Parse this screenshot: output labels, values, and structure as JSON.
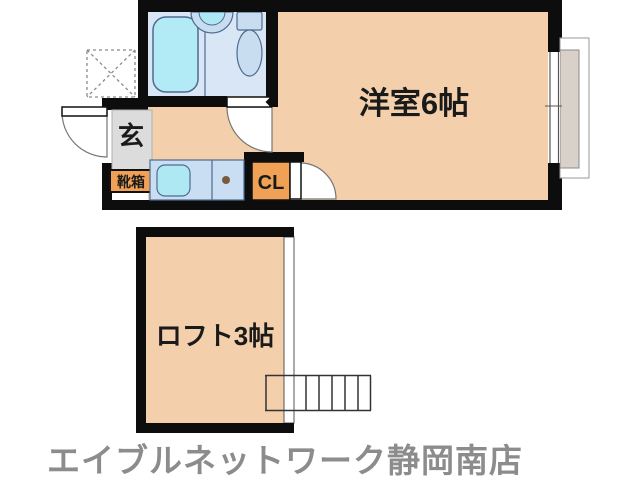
{
  "plan": {
    "labels": {
      "main_room": "洋室6帖",
      "loft": "ロフト3帖",
      "entrance": "玄",
      "shoe_box": "靴箱",
      "closet": "CL"
    },
    "footer": "エイブルネットワーク静岡南店",
    "fixtures": {
      "bathtub": "bathtub",
      "washbasin": "washbasin",
      "toilet": "toilet",
      "sink_counter": "sink-counter",
      "washing_machine_space": "washing-machine-space",
      "window": "window-with-shutter",
      "ladder": "loft-ladder"
    },
    "colors": {
      "wall": "#0d0d0d",
      "room_floor": "#f3cfab",
      "bathroom_floor": "#d9e6f5",
      "fixture_fill": "#c9ddf1",
      "tub_fill": "#b2ebf5",
      "sink_fill": "#aee9f3",
      "counter_fill": "#c9def2",
      "accent_orange": "#f0a155",
      "entrance_gray": "#dcdcdc",
      "shutter_gray": "#d8d0c9",
      "footer_text": "#8c8c8c"
    }
  }
}
